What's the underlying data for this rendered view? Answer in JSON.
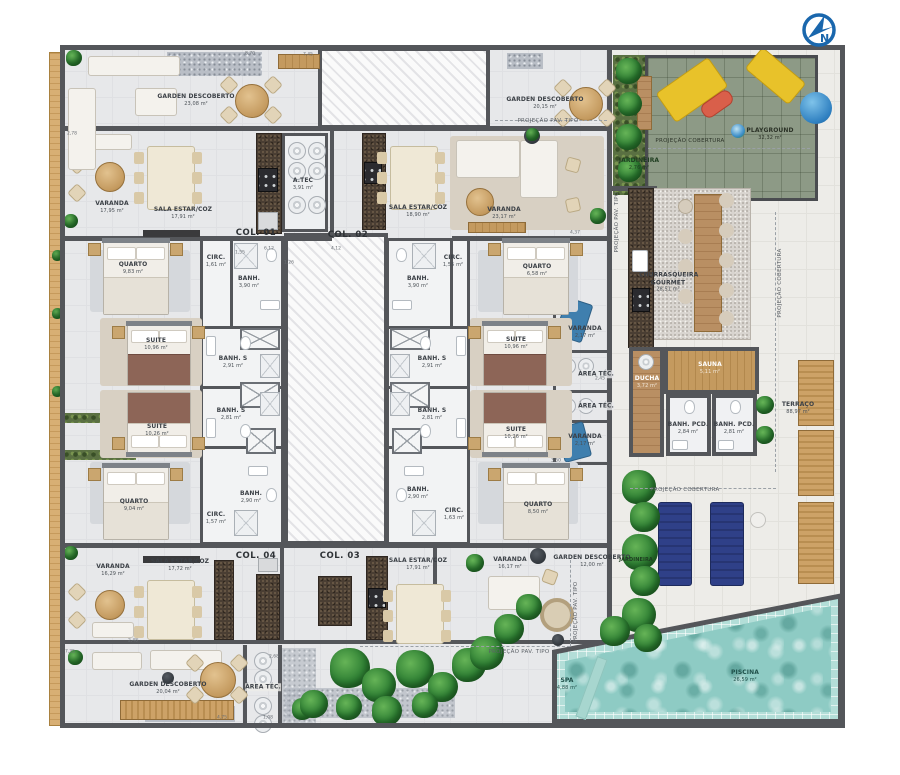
{
  "compass": {
    "label": "N"
  },
  "cols": {
    "c1": "COL. 01",
    "c2": "COL. 02",
    "c3": "COL. 03",
    "c4": "COL. 04"
  },
  "projections": {
    "pav_tipo": "PROJEÇÃO PAV. TIPO",
    "cobertura": "PROJEÇÃO COBERTURA"
  },
  "rooms": {
    "garden_tl": {
      "name": "GARDEN DESCOBERTO",
      "area": "23,08 m²"
    },
    "varanda_tl": {
      "name": "VARANDA",
      "area": "17,95 m²"
    },
    "sala_tl": {
      "name": "SALA ESTAR/COZ",
      "area": "17,91 m²"
    },
    "atec_tl": {
      "name": "A.TEC",
      "area": "3,91 m²"
    },
    "garden_tm": {
      "name": "GARDEN DESCOBERTO",
      "area": "20,15 m²"
    },
    "sala_tm": {
      "name": "SALA ESTAR/COZ",
      "area": "18,90 m²"
    },
    "varanda_tm": {
      "name": "VARANDA",
      "area": "23,17 m²"
    },
    "quarto_tl": {
      "name": "QUARTO",
      "area": "9,83 m²"
    },
    "circ_tl": {
      "name": "CIRC.",
      "area": "1,61 m²"
    },
    "banh_tl": {
      "name": "BANH.",
      "area": "3,90 m²"
    },
    "suite1_l": {
      "name": "SUITE",
      "area": "10,96 m²"
    },
    "banhs1_l": {
      "name": "BANH. S",
      "area": "2,91 m²"
    },
    "suite2_l": {
      "name": "SUITE",
      "area": "10,26 m²"
    },
    "banhs2_l": {
      "name": "BANH. S",
      "area": "2,81 m²"
    },
    "quarto_bl": {
      "name": "QUARTO",
      "area": "9,04 m²"
    },
    "circ_bl": {
      "name": "CIRC.",
      "area": "1,57 m²"
    },
    "banh_bl": {
      "name": "BANH.",
      "area": "2,90 m²"
    },
    "varanda_bl": {
      "name": "VARANDA",
      "area": "16,29 m²"
    },
    "sala_bl": {
      "name": "SALA ESTAR/COZ",
      "area": "17,72 m²"
    },
    "garden_bl": {
      "name": "GARDEN DESCOBERTO",
      "area": "20,04 m²"
    },
    "atec_bl": {
      "name": "ÁREA TÉC.",
      "area": ""
    },
    "quarto_tr": {
      "name": "QUARTO",
      "area": "6,58 m²"
    },
    "circ_tr": {
      "name": "CIRC.",
      "area": "1,55 m²"
    },
    "banh_tr": {
      "name": "BANH.",
      "area": "3,90 m²"
    },
    "suite1_r": {
      "name": "SUITE",
      "area": "10,96 m²"
    },
    "banhs1_r": {
      "name": "BANH. S",
      "area": "2,91 m²"
    },
    "suite2_r": {
      "name": "SUITE",
      "area": "10,26 m²"
    },
    "banhs2_r": {
      "name": "BANH. S",
      "area": "2,81 m²"
    },
    "quarto_br": {
      "name": "QUARTO",
      "area": "8,50 m²"
    },
    "circ_br": {
      "name": "CIRC.",
      "area": "1,63 m²"
    },
    "banh_br": {
      "name": "BANH.",
      "area": "2,90 m²"
    },
    "varanda_r1": {
      "name": "VARANDA",
      "area": "2,17 m²"
    },
    "varanda_r2": {
      "name": "VARANDA",
      "area": "2,17 m²"
    },
    "atec_r1": {
      "name": "ÁREA TÉC.",
      "area": ""
    },
    "atec_r2": {
      "name": "ÁREA TÉC.",
      "area": ""
    },
    "sala_bm": {
      "name": "SALA ESTAR/COZ",
      "area": "17,91 m²"
    },
    "varanda_bm": {
      "name": "VARANDA",
      "area": "16,17 m²"
    },
    "garden_bm": {
      "name": "GARDEN DESCOBERTO",
      "area": "12,00 m²"
    },
    "playground": {
      "name": "PLAYGROUND",
      "area": "32,32 m²"
    },
    "churrasqueira": {
      "name": "CHURRASQUEIRA GOURMET",
      "area": "28,51 m²"
    },
    "jardineira_1": {
      "name": "JARDINEIRA",
      "area": "2,76 m²"
    },
    "jardineira_2": {
      "name": "JARDINEIRA",
      "area": ""
    },
    "ducha": {
      "name": "DUCHA",
      "area": "3,72 m²"
    },
    "sauna": {
      "name": "SAUNA",
      "area": "5,11 m²"
    },
    "banpcd_1": {
      "name": "BANH. PCD.",
      "area": "2,84 m²"
    },
    "banpcd_2": {
      "name": "BANH. PCD.",
      "area": "2,81 m²"
    },
    "terraco": {
      "name": "TERRAÇO",
      "area": "88,97 m²"
    },
    "piscina": {
      "name": "PISCINA",
      "area": "26,59 m²"
    },
    "spa": {
      "name": "SPA",
      "area": "4,88 m²"
    }
  },
  "dims": {
    "d1": "8,70",
    "d2": "7,45",
    "d3": "2,78",
    "d4": "1,26",
    "d5": "1,55",
    "d6": "4,37",
    "d7": "3,50",
    "d8": "2,45",
    "d9": "4,75",
    "d10": "1,08",
    "d11": "2,48",
    "d12": "2,68",
    "d13": "7,35",
    "d14": "6,12",
    "d15": "4,12"
  }
}
